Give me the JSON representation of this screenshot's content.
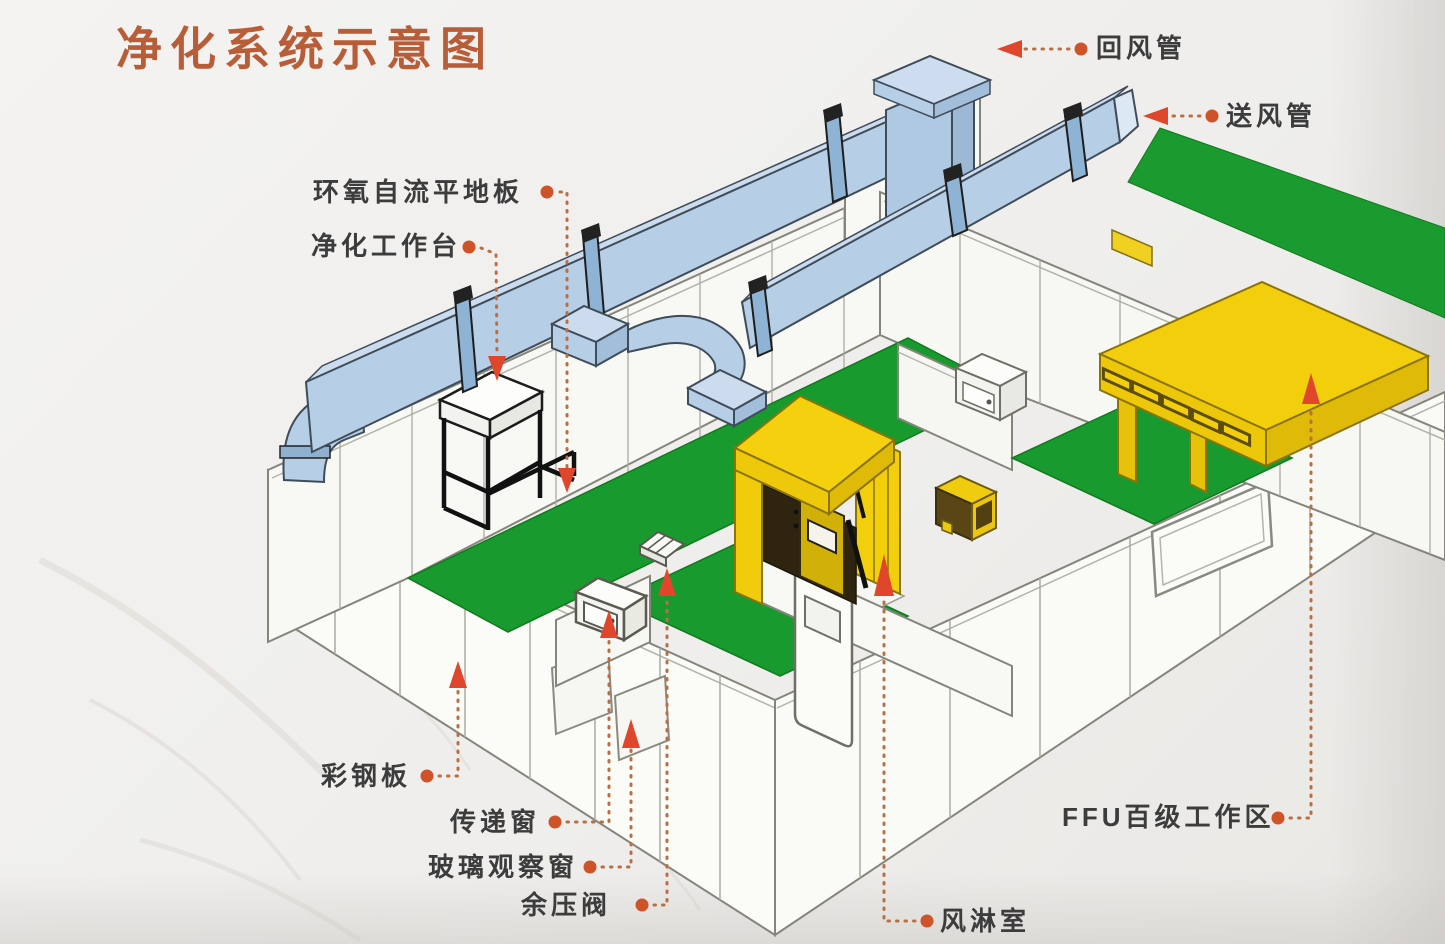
{
  "title": "净化系统示意图",
  "labels": [
    {
      "id": "return-duct",
      "text": "回风管"
    },
    {
      "id": "supply-duct",
      "text": "送风管"
    },
    {
      "id": "epoxy-floor",
      "text": "环氧自流平地板"
    },
    {
      "id": "clean-workbench",
      "text": "净化工作台"
    },
    {
      "id": "color-steel-panel",
      "text": "彩钢板"
    },
    {
      "id": "transfer-window",
      "text": "传递窗"
    },
    {
      "id": "glass-observation-window",
      "text": "玻璃观察窗"
    },
    {
      "id": "pressure-relief-valve",
      "text": "余压阀"
    },
    {
      "id": "air-shower-room",
      "text": "风淋室"
    },
    {
      "id": "ffu-class100-area",
      "text": "FFU百级工作区"
    }
  ],
  "colors": {
    "title": "#b95c38",
    "label_text": "#3c3c3c",
    "leader_dots": "#b96f46",
    "leader_bullet": "#cf5329",
    "leader_arrow": "#e0462c",
    "duct_blue": "#b7cfe6",
    "floor_green": "#189a2e",
    "equipment_yellow": "#f2ce0c",
    "wall_white": "#fafaf7"
  }
}
